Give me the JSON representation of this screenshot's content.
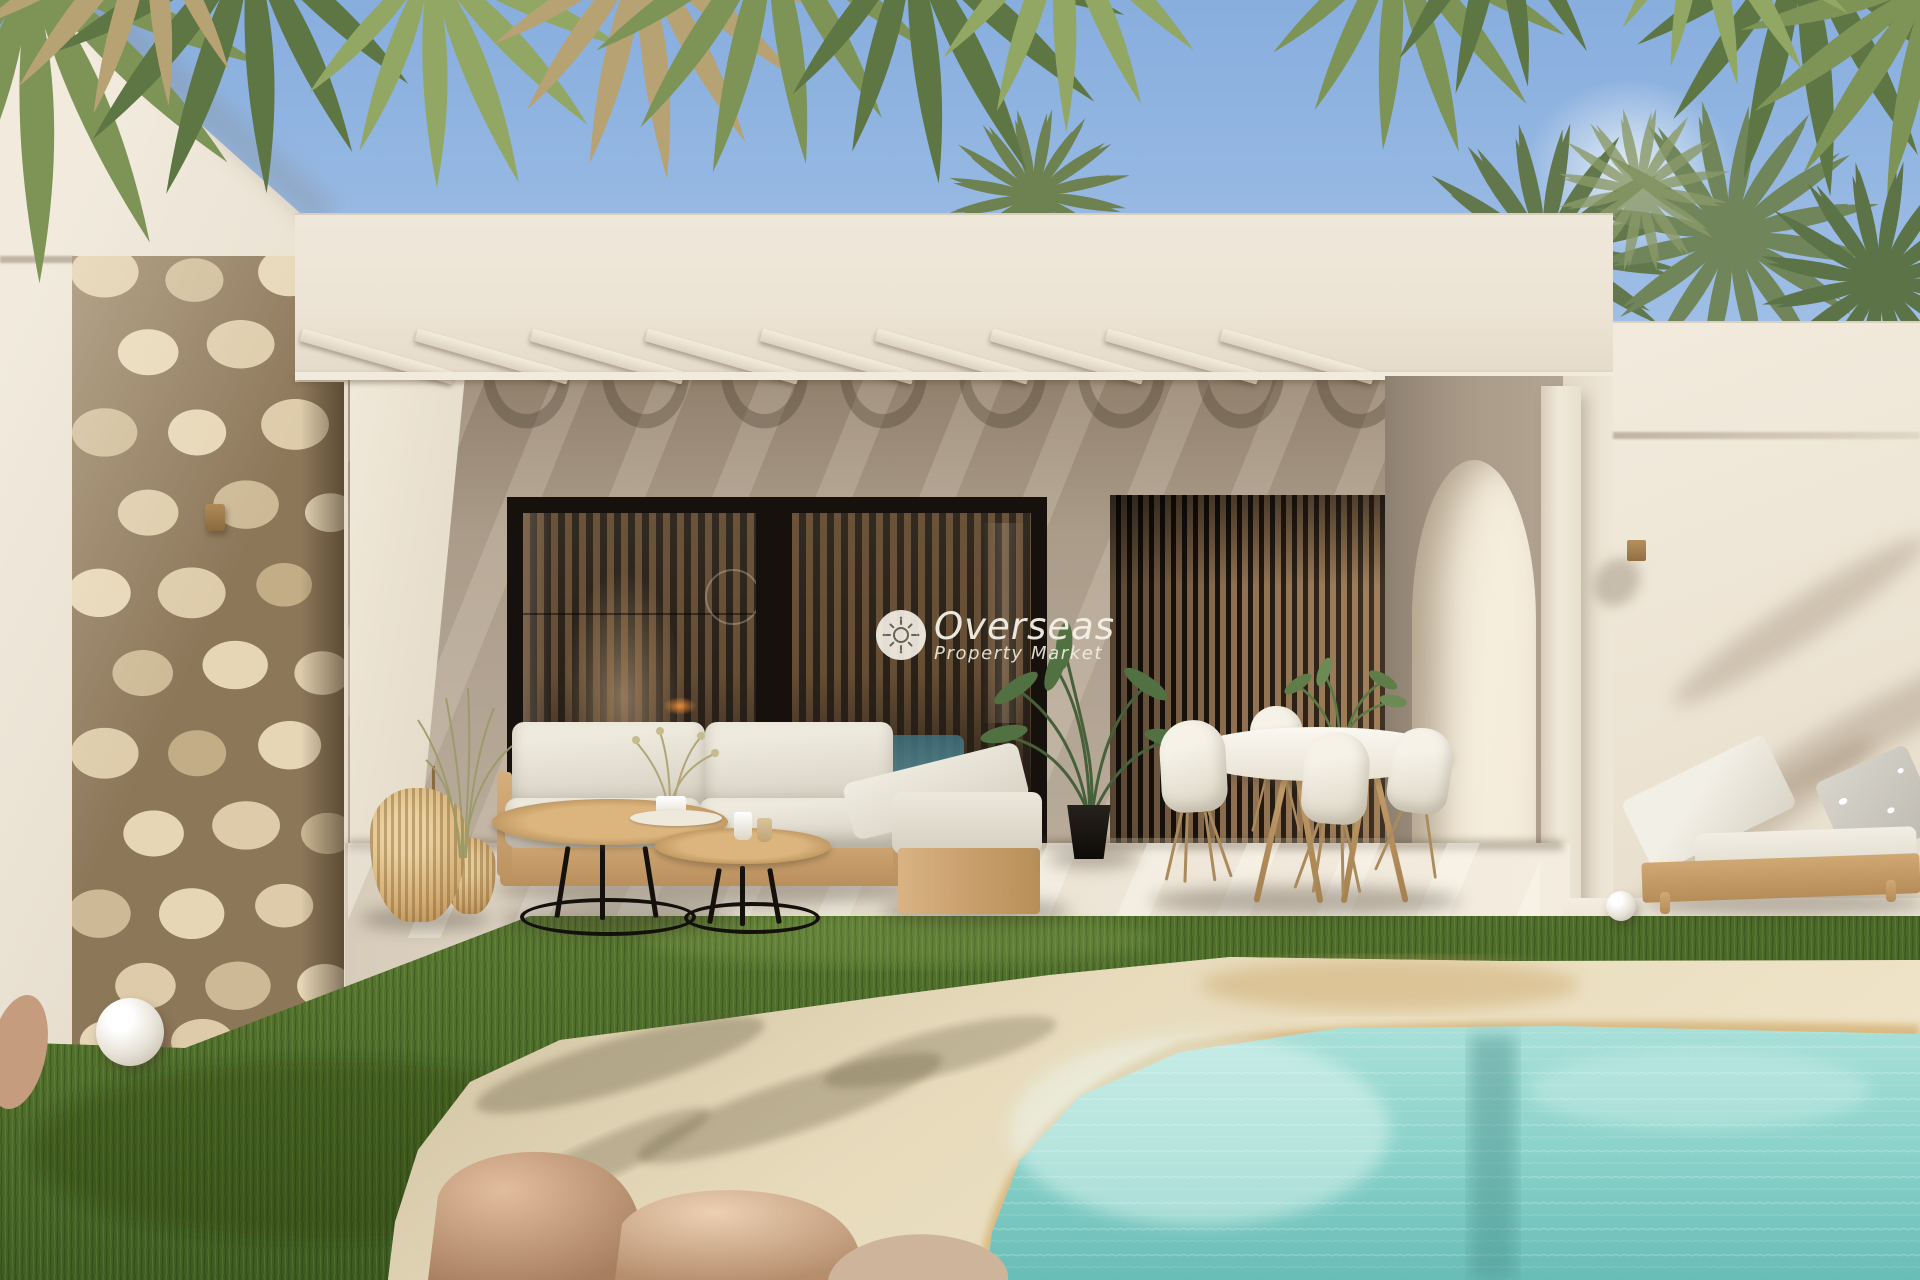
{
  "watermark": {
    "brand": "Overseas",
    "tagline": "Property Market",
    "icon": "sun-logo-icon"
  },
  "scene": {
    "type": "architectural-render",
    "description": "Modern Mediterranean villa with covered terrace, natural stone feature wall, outdoor lounge and dining furniture, lawn and beach-entry pool framed by palm trees",
    "time_of_day": "day"
  },
  "colors": {
    "sky-top": "#88aede",
    "sky-low": "#cfe0f3",
    "wall-lit": "#ede5d7",
    "wall-shade": "#d9cfc0",
    "recess-top": "#8f7f6b",
    "recess-mid": "#ab9c8a",
    "recess-low": "#b9ab9a",
    "stone-light": "#ddcba9",
    "stone-mid": "#cdb995",
    "mortar": "#8d7759",
    "frame": "#17110d",
    "glass": "#2e251c",
    "slat": "#8f7050",
    "louver-bg": "#1b140e",
    "grass-hi": "#5c7a33",
    "grass-lo": "#3a551e",
    "sand-hi": "#eee3c6",
    "sand-lo": "#cfc1a0",
    "wet-sand": "#d5b277",
    "water-hi": "#a7dfd8",
    "water-lo": "#68bdb6",
    "wood": "#c89e68",
    "cushion": "#e9e4d9",
    "rock": "#c79f82",
    "watermark": "#f3efe5"
  }
}
